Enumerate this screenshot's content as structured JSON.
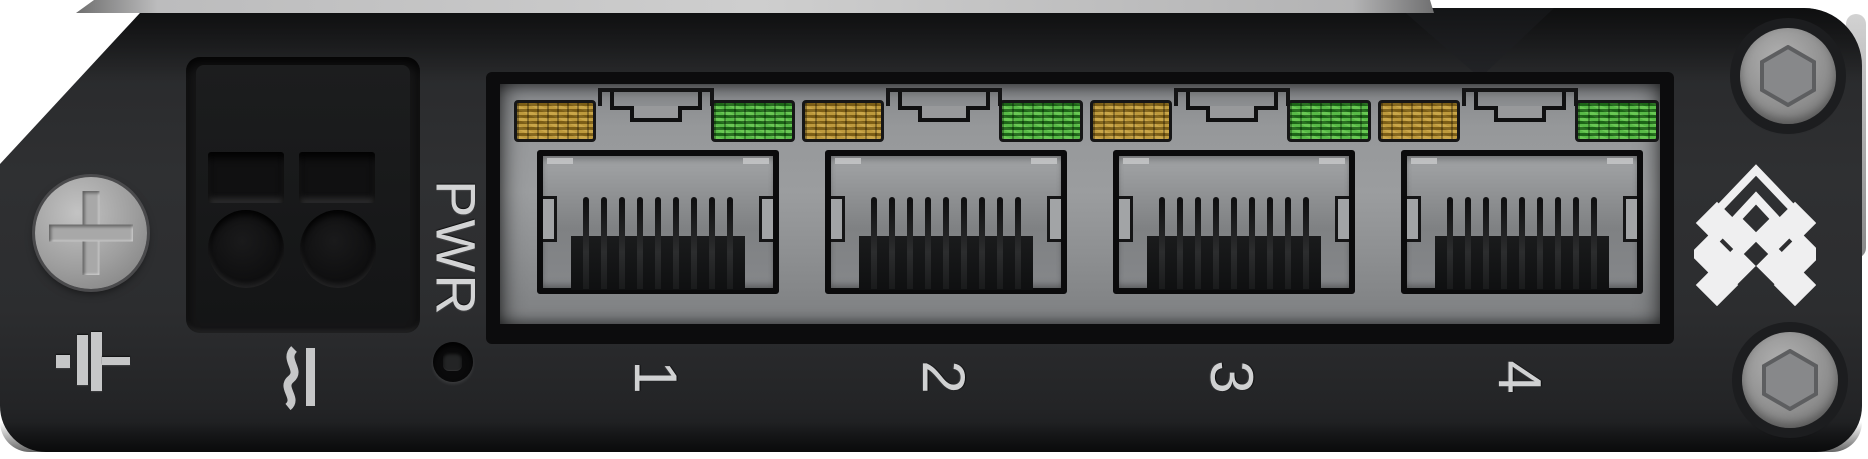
{
  "panel": {
    "power": {
      "label": "PWR"
    },
    "ports": [
      {
        "label": "1",
        "led_left": "orange",
        "led_right": "green"
      },
      {
        "label": "2",
        "led_left": "orange",
        "led_right": "green"
      },
      {
        "label": "3",
        "led_left": "orange",
        "led_right": "green"
      },
      {
        "label": "4",
        "led_left": "orange",
        "led_right": "green"
      }
    ],
    "colors": {
      "background": "#ffffff",
      "panel_body": "#2b2c2e",
      "port_shield_metal": "#8f9193",
      "led_orange": "#b1882d",
      "led_green": "#3aa233",
      "engraved_text": "#d3d4d5",
      "screw_gray": "#9c9c9c"
    },
    "icons": {
      "left_screw": "phillips-screw-icon",
      "ground": "ground-icon",
      "power_terminal": "dc-power-terminal",
      "ac_dc_mark": "ac-dc-current-icon",
      "power_led": "power-led",
      "brand_logo": "chevron-brand-logo-icon",
      "hex_screws": "hex-socket-screw-icon"
    }
  }
}
